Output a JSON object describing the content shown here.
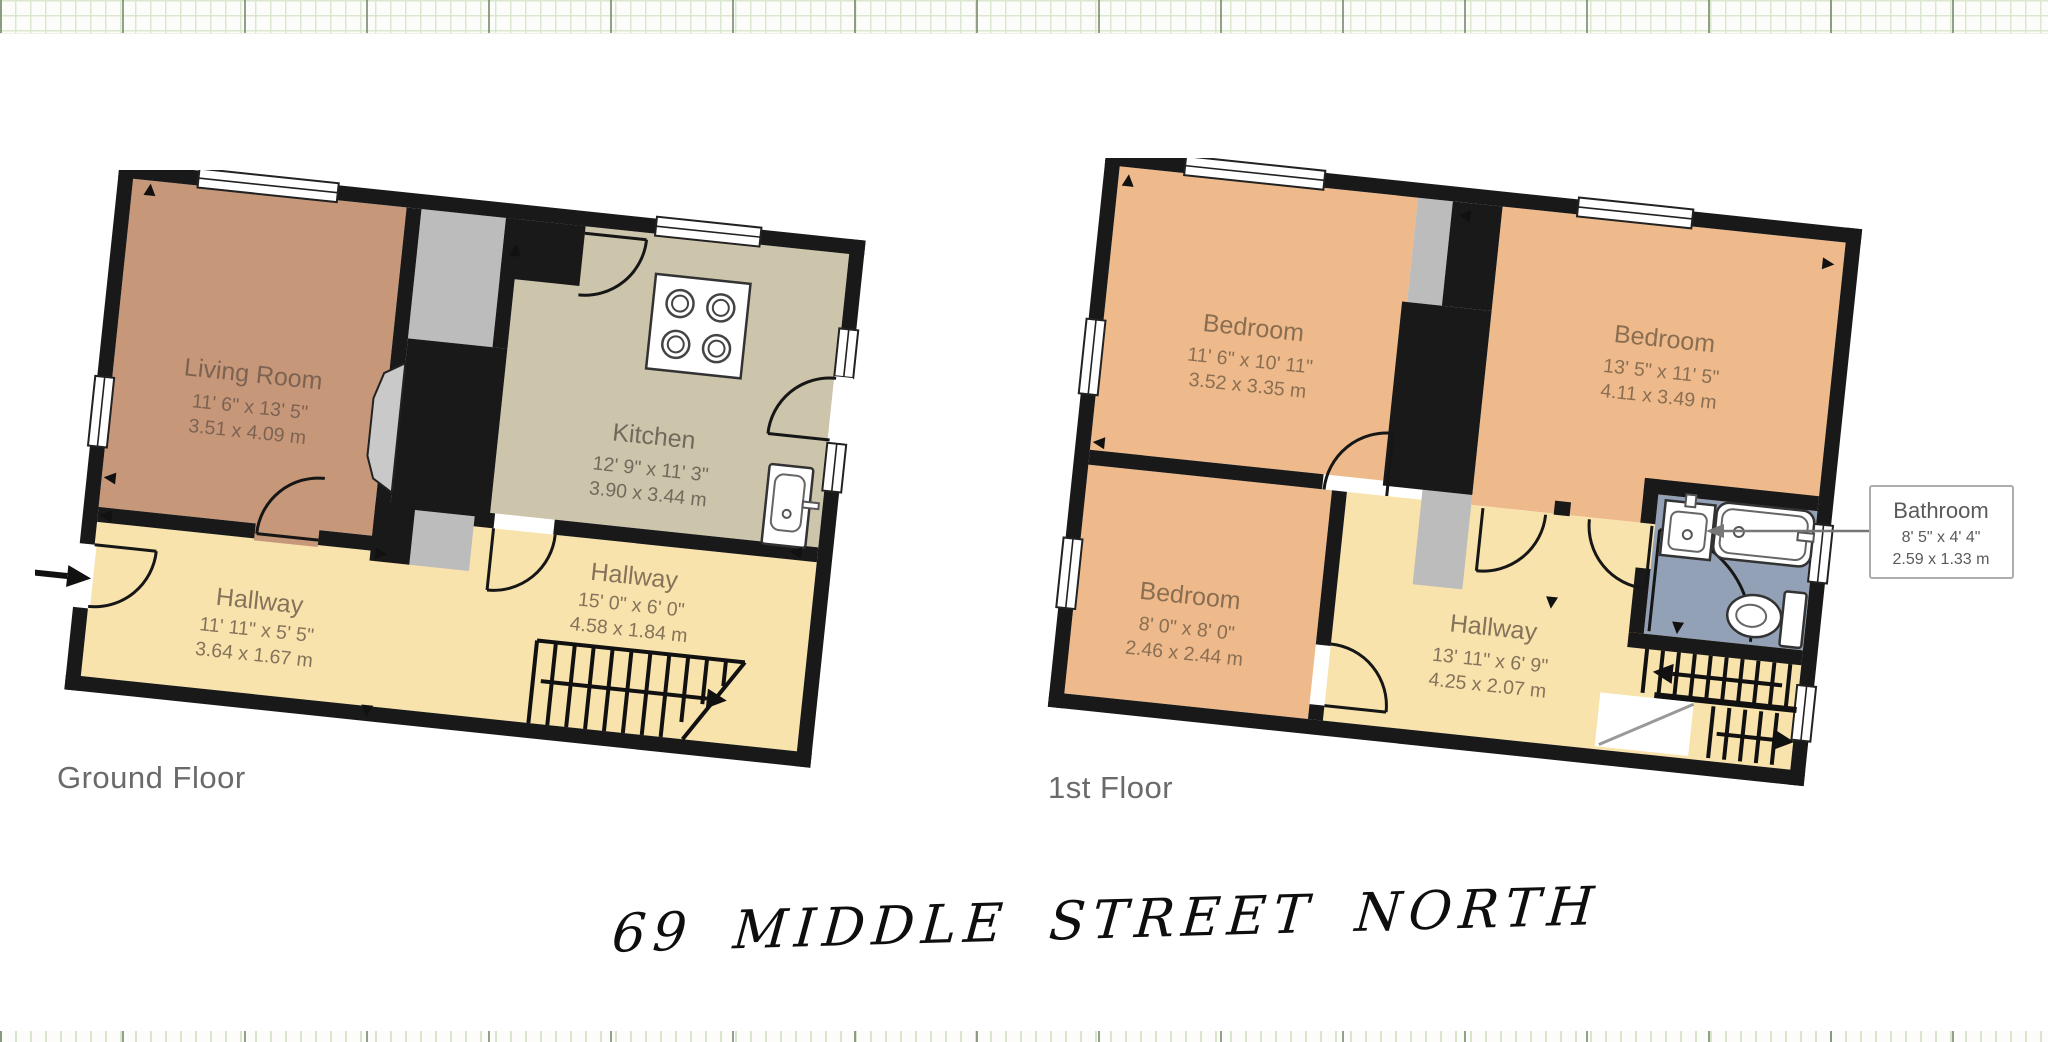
{
  "page": {
    "handwritten_title": "69 MIDDLE STREET NORTH"
  },
  "palette": {
    "wall": "#191919",
    "living_room_fill": "#c69879",
    "kitchen_fill": "#cdc5ab",
    "hallway_fill": "#f8e3ac",
    "bedroom_fill": "#eeba8b",
    "bathroom_fill": "#92a1b5",
    "closet_fill": "#bcbcbc",
    "room_label_color": "#7a6554",
    "floor_label_color": "#6a6a6a",
    "grid_line_green": "#dbe7cd"
  },
  "floors": [
    {
      "label": "Ground Floor",
      "rooms": [
        {
          "name": "Living Room",
          "imperial": "11' 6\" x 13' 5\"",
          "metric": "3.51 x 4.09 m"
        },
        {
          "name": "Kitchen",
          "imperial": "12' 9\" x 11' 3\"",
          "metric": "3.90 x 3.44 m"
        },
        {
          "name": "Hallway",
          "imperial": "15' 0\" x 6' 0\"",
          "metric": "4.58 x 1.84 m"
        },
        {
          "name": "Hallway",
          "imperial": "11' 11\" x 5' 5\"",
          "metric": "3.64 x 1.67 m"
        }
      ]
    },
    {
      "label": "1st Floor",
      "rooms": [
        {
          "name": "Bedroom",
          "imperial": "11' 6\" x 10' 11\"",
          "metric": "3.52 x 3.35 m"
        },
        {
          "name": "Bedroom",
          "imperial": "13' 5\" x 11' 5\"",
          "metric": "4.11 x 3.49 m"
        },
        {
          "name": "Bedroom",
          "imperial": "8' 0\" x 8' 0\"",
          "metric": "2.46 x 2.44 m"
        },
        {
          "name": "Hallway",
          "imperial": "13' 11\" x 6' 9\"",
          "metric": "4.25 x 2.07 m"
        }
      ],
      "callout": {
        "name": "Bathroom",
        "imperial": "8' 5\" x 4' 4\"",
        "metric": "2.59 x 1.33 m"
      }
    }
  ]
}
